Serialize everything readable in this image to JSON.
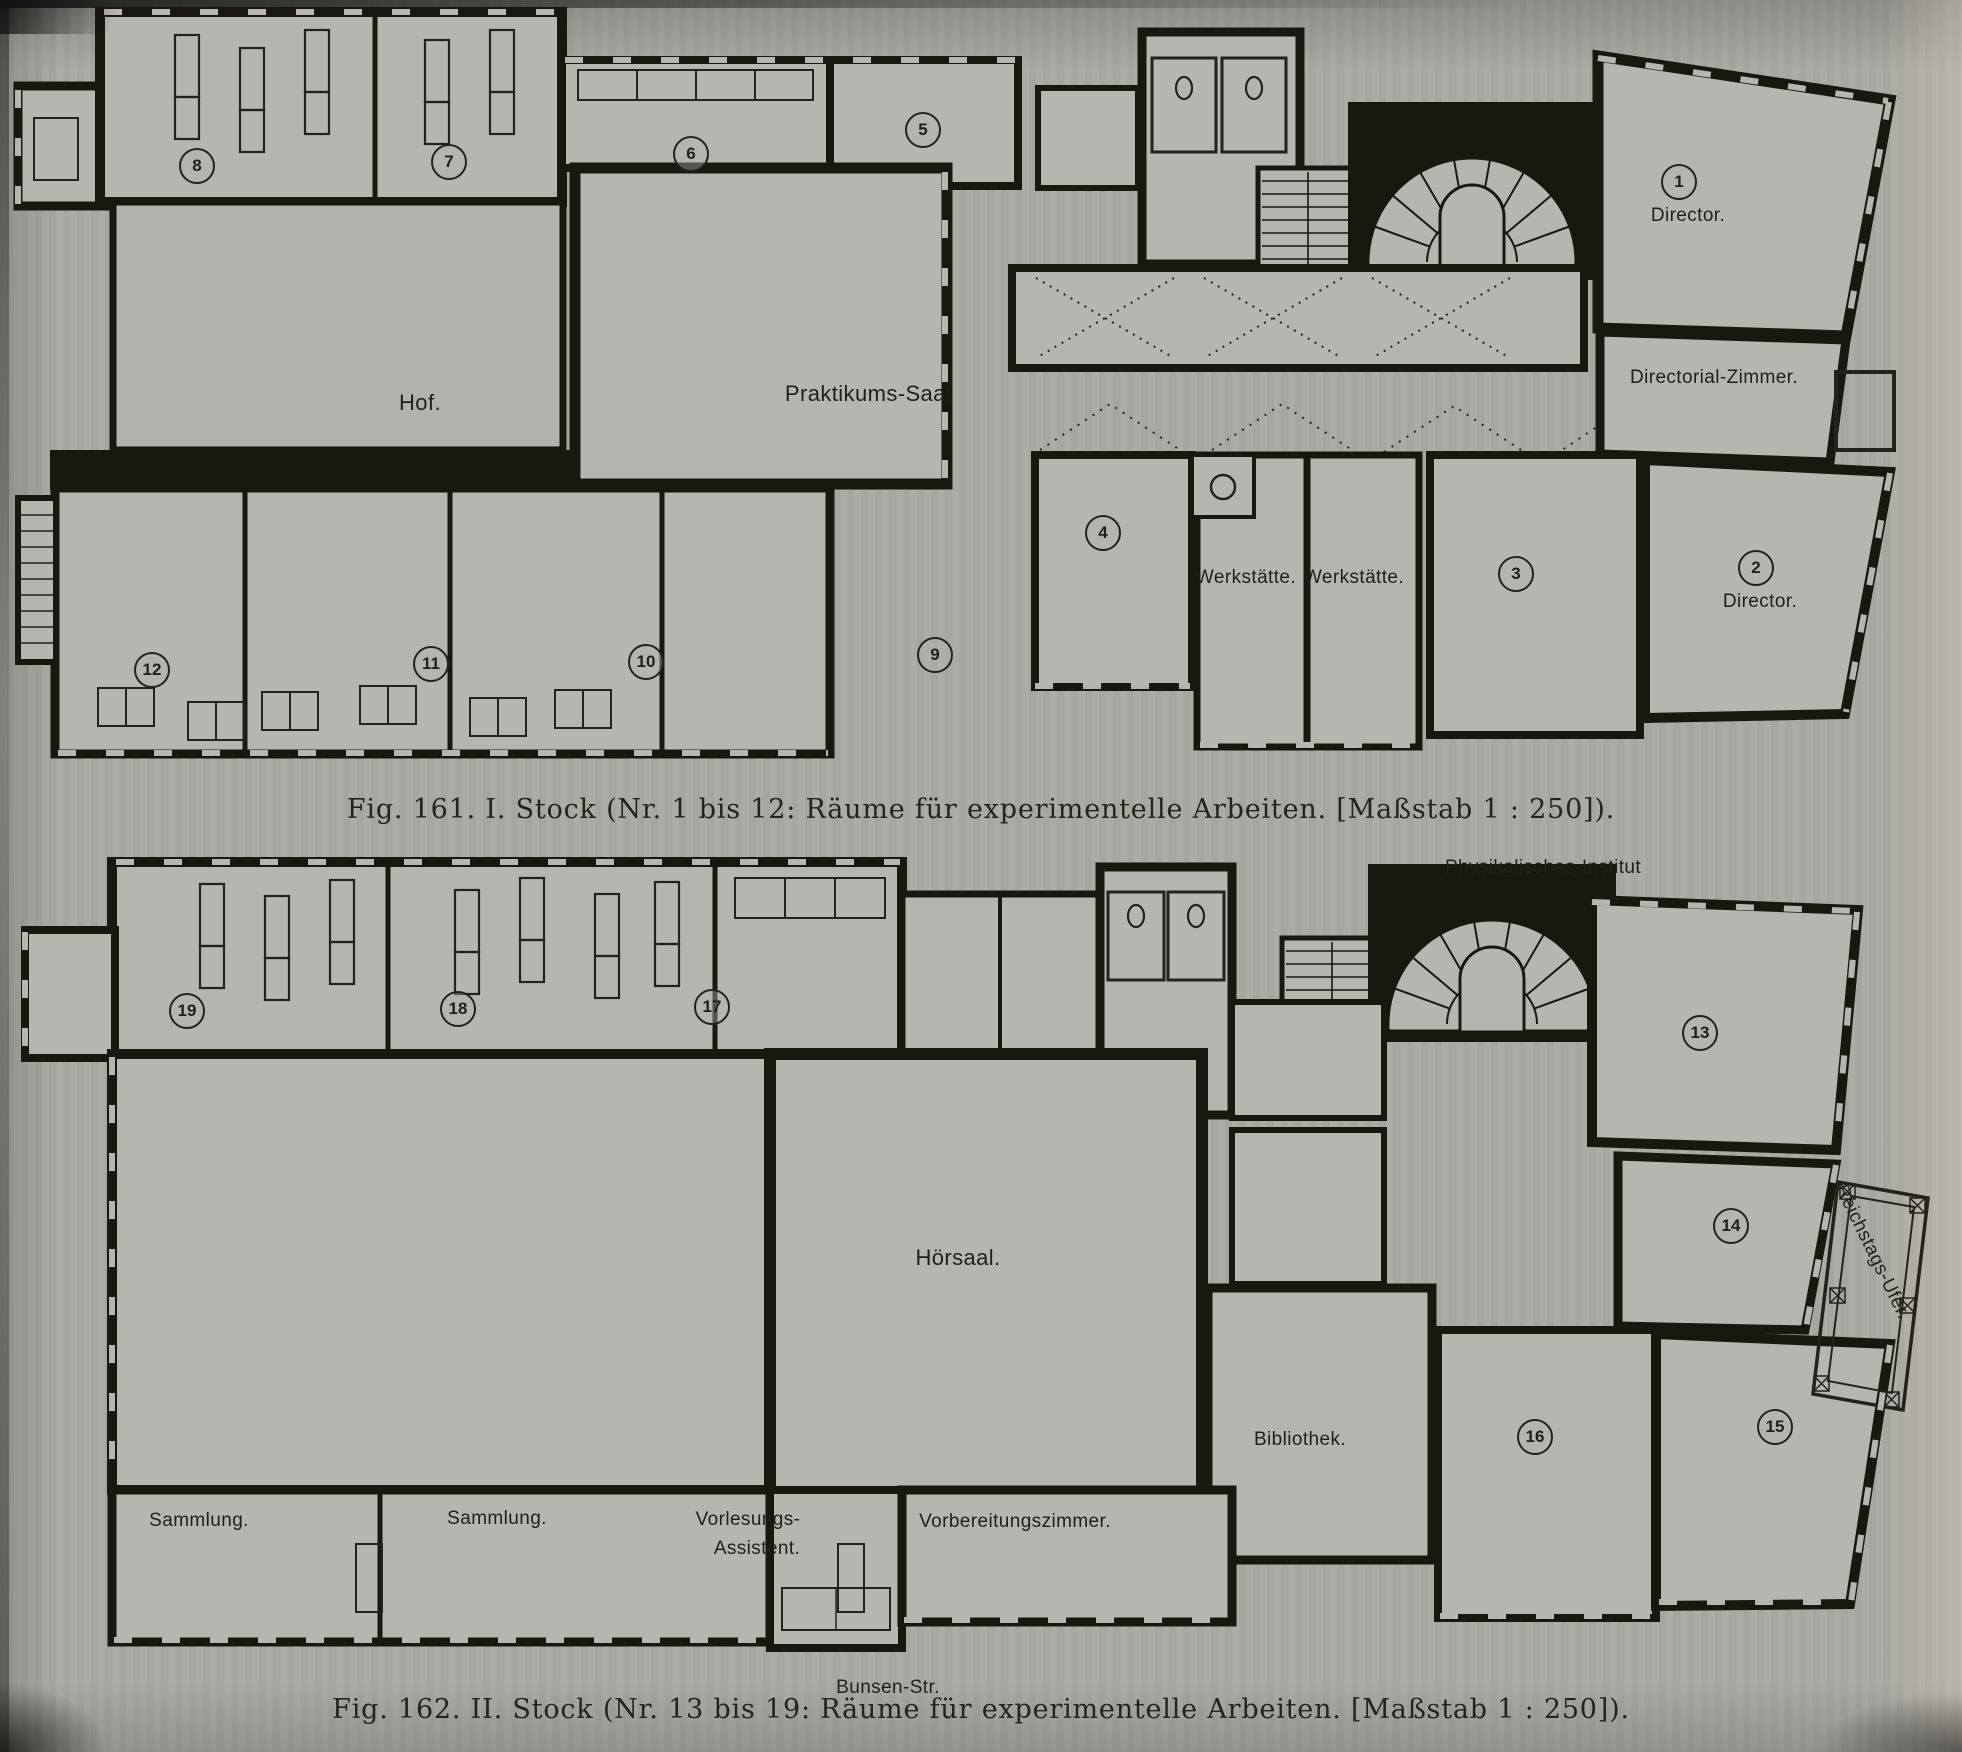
{
  "colors": {
    "paper": "#aaa9a3",
    "room_fill": "#b6b5b0",
    "ink": "#181710"
  },
  "figures": [
    {
      "id": "fig-161",
      "caption": "Fig. 161.   I. Stock (Nr. 1 bis 12: Räume für experimentelle Arbeiten.   [Maßstab 1 : 250]).",
      "labels": [
        {
          "t": "8",
          "x": 197,
          "y": 166,
          "k": "num"
        },
        {
          "t": "7",
          "x": 449,
          "y": 162,
          "k": "num"
        },
        {
          "t": "6",
          "x": 691,
          "y": 154,
          "k": "num"
        },
        {
          "t": "5",
          "x": 923,
          "y": 130,
          "k": "num"
        },
        {
          "t": "1",
          "x": 1679,
          "y": 182,
          "k": "num"
        },
        {
          "t": "Director.",
          "x": 1688,
          "y": 216,
          "k": "name"
        },
        {
          "t": "Directorial-Zimmer.",
          "x": 1714,
          "y": 378,
          "k": "name"
        },
        {
          "t": "Hof.",
          "x": 420,
          "y": 403,
          "k": "name",
          "big": true
        },
        {
          "t": "Praktikums-Saal",
          "x": 868,
          "y": 394,
          "k": "name",
          "big": true
        },
        {
          "t": "4",
          "x": 1103,
          "y": 533,
          "k": "num"
        },
        {
          "t": "Werkstätte.",
          "x": 1246,
          "y": 578,
          "k": "name"
        },
        {
          "t": "Werkstätte.",
          "x": 1354,
          "y": 578,
          "k": "name"
        },
        {
          "t": "3",
          "x": 1516,
          "y": 574,
          "k": "num"
        },
        {
          "t": "2",
          "x": 1756,
          "y": 568,
          "k": "num"
        },
        {
          "t": "Director.",
          "x": 1760,
          "y": 602,
          "k": "name"
        },
        {
          "t": "9",
          "x": 935,
          "y": 655,
          "k": "num"
        },
        {
          "t": "10",
          "x": 646,
          "y": 662,
          "k": "num"
        },
        {
          "t": "11",
          "x": 431,
          "y": 664,
          "k": "num"
        },
        {
          "t": "12",
          "x": 152,
          "y": 670,
          "k": "num"
        }
      ]
    },
    {
      "id": "fig-162",
      "caption": "Fig. 162.   II. Stock (Nr. 13 bis 19: Räume für experimentelle Arbeiten.   [Maßstab 1 : 250]).",
      "labels": [
        {
          "t": "Physikalisches-Institut",
          "x": 1543,
          "y": 868,
          "k": "name"
        },
        {
          "t": "19",
          "x": 187,
          "y": 1011,
          "k": "num"
        },
        {
          "t": "18",
          "x": 458,
          "y": 1009,
          "k": "num"
        },
        {
          "t": "17",
          "x": 712,
          "y": 1007,
          "k": "num"
        },
        {
          "t": "13",
          "x": 1700,
          "y": 1033,
          "k": "num"
        },
        {
          "t": "Hörsaal.",
          "x": 958,
          "y": 1258,
          "k": "name",
          "big": true
        },
        {
          "t": "14",
          "x": 1731,
          "y": 1226,
          "k": "num"
        },
        {
          "t": "Reichstags-Ufer.",
          "x": 1872,
          "y": 1252,
          "k": "name",
          "rot": 64
        },
        {
          "t": "Bibliothek.",
          "x": 1300,
          "y": 1440,
          "k": "name"
        },
        {
          "t": "16",
          "x": 1535,
          "y": 1437,
          "k": "num"
        },
        {
          "t": "15",
          "x": 1775,
          "y": 1427,
          "k": "num"
        },
        {
          "t": "Sammlung.",
          "x": 199,
          "y": 1521,
          "k": "name"
        },
        {
          "t": "Sammlung.",
          "x": 497,
          "y": 1519,
          "k": "name"
        },
        {
          "t": "Vorlesungs-",
          "x": 748,
          "y": 1520,
          "k": "name"
        },
        {
          "t": "Assistent.",
          "x": 757,
          "y": 1549,
          "k": "name"
        },
        {
          "t": "Vorbereitungszimmer.",
          "x": 1015,
          "y": 1522,
          "k": "name"
        },
        {
          "t": "Bunsen-Str.",
          "x": 888,
          "y": 1688,
          "k": "name"
        }
      ]
    }
  ]
}
